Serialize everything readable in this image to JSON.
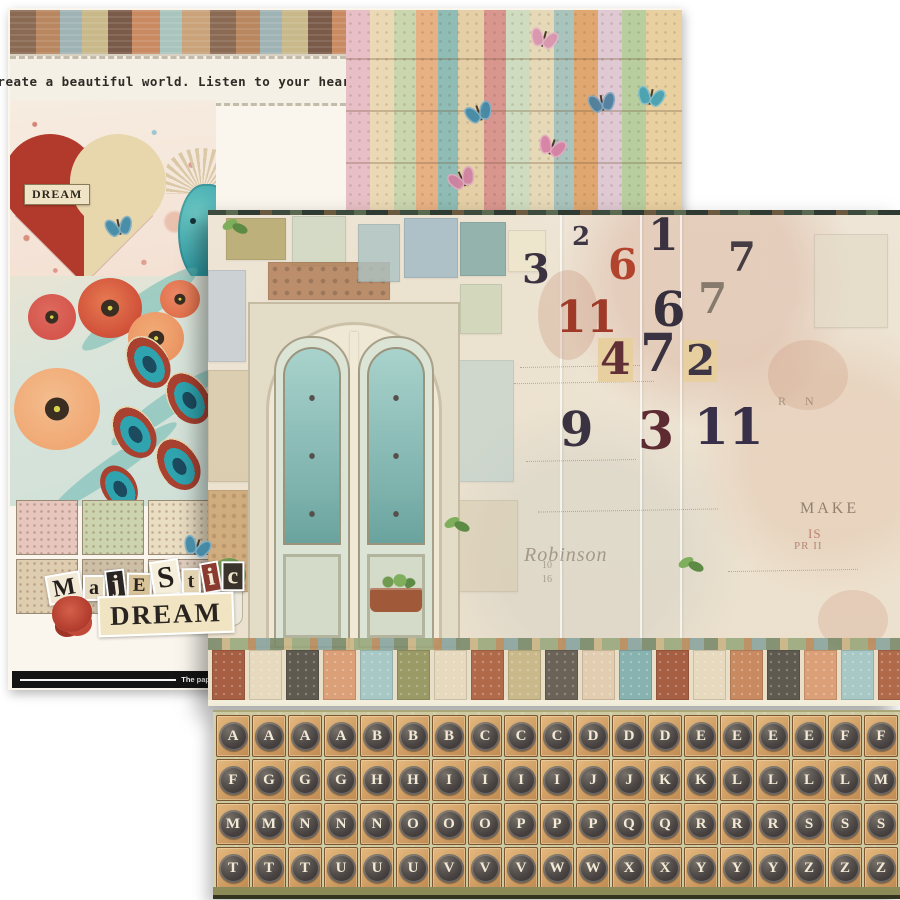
{
  "back_sheet": {
    "header_text": "Create a beautiful world.  Listen to your heart.",
    "heart_label": "DREAM",
    "title_word1": "Majestic",
    "title_word2": "DREAM",
    "footer_text": "The pap",
    "title_letters": [
      {
        "ch": "M",
        "fg": "#241f1c",
        "bg": "#f2ead6"
      },
      {
        "ch": "a",
        "fg": "#241f1c",
        "bg": "#e8dcc0"
      },
      {
        "ch": "j",
        "fg": "#f2ead6",
        "bg": "#2a2522"
      },
      {
        "ch": "E",
        "fg": "#2a2522",
        "bg": "#d9c49a"
      },
      {
        "ch": "S",
        "fg": "#241f1c",
        "bg": "#f4eeda"
      },
      {
        "ch": "t",
        "fg": "#2a2522",
        "bg": "#e2d3b2"
      },
      {
        "ch": "i",
        "fg": "#f2ead6",
        "bg": "#8a3a2e"
      },
      {
        "ch": "c",
        "fg": "#f0e6cc",
        "bg": "#3a332c"
      }
    ],
    "swatch_colors": [
      "#e6c6bd",
      "#ccd4ae",
      "#e9ddc2",
      "#dfcdb0",
      "#cdbfa6",
      "#e3d2c0"
    ],
    "patchwork": {
      "strip_colors": [
        "#e8bfc6",
        "#ead9b4",
        "#c9d6ae",
        "#e8b184",
        "#8fbcb4",
        "#e4cfa6",
        "#d9968e",
        "#cfdcc0",
        "#e6d9b8",
        "#a8c4bc",
        "#e0a870",
        "#dfc9d2",
        "#b8ce9e",
        "#e8d0a0"
      ],
      "butterfly_colors": [
        "#3e88a8",
        "#d993ae",
        "#4a7d9e",
        "#d77fa4",
        "#cf7fa0",
        "#44a0b2"
      ]
    },
    "heart_colors": {
      "left": "#b23a2c",
      "right": "#e8d6ad"
    },
    "peacock_color": "#2f9aa4",
    "poppy_colors": [
      "#cf4f38",
      "#d4554c",
      "#eb9663",
      "#f0a874",
      "#e2704a"
    ]
  },
  "front_sheet": {
    "numbers": [
      {
        "value": "2",
        "color": "#3e3644"
      },
      {
        "value": "1",
        "color": "#3a3240"
      },
      {
        "value": "3",
        "color": "#3a3240"
      },
      {
        "value": "6",
        "color": "#b2432d"
      },
      {
        "value": "7",
        "color": "#463c44"
      },
      {
        "value": "11",
        "color": "#a03a28"
      },
      {
        "value": "6",
        "color": "#362f3d"
      },
      {
        "value": "7",
        "color": "#857a6c"
      },
      {
        "value": "4",
        "color": "#613037",
        "bg": "#e7cfa0"
      },
      {
        "value": "7",
        "color": "#3a3240"
      },
      {
        "value": "2",
        "color": "#3e3644",
        "bg": "#e7cfa0"
      },
      {
        "value": "9",
        "color": "#3a3240"
      },
      {
        "value": "3",
        "color": "#5e2b33"
      },
      {
        "value": "11",
        "color": "#383048"
      }
    ],
    "script_fragments": [
      {
        "text": "MAKE",
        "color": "rgba(90,72,58,.60)"
      },
      {
        "text": "IS",
        "color": "rgba(150,62,48,.55)"
      },
      {
        "text": "PR II",
        "color": "rgba(130,55,42,.50)"
      },
      {
        "text": "Robinson",
        "color": "rgba(105,88,70,.50)",
        "italic": true
      },
      {
        "text": "R N",
        "color": "rgba(90,78,64,.45)"
      },
      {
        "text": "10",
        "color": "rgba(110,95,80,.50)"
      },
      {
        "text": "16",
        "color": "rgba(110,95,80,.50)"
      }
    ],
    "border_colors": [
      "#a65f43",
      "#e6d9bd",
      "#5f5a50",
      "#dba077",
      "#a8c8c6",
      "#9a9a66",
      "#e6d9bd",
      "#b06a4a",
      "#c9b98a",
      "#6b6358",
      "#e2cdb0",
      "#87b2b0",
      "#a65f43",
      "#e6d9bd",
      "#c98a62",
      "#5f5a50",
      "#dba077",
      "#a8c8c6",
      "#b06a4a"
    ],
    "door_colors": {
      "frame": "#efe8d4",
      "leaf": "#dce4d6",
      "glass": "#7fb3ae",
      "planter": "#a05a3a"
    }
  },
  "key_strip": {
    "background": "#cdc9a0",
    "key_tile": "#c08b52",
    "key_cap": "#474140",
    "letter_color": "#f2ead6",
    "rows": [
      [
        "A",
        "A",
        "A",
        "A",
        "B",
        "B",
        "B",
        "C",
        "C",
        "C",
        "D",
        "D",
        "D",
        "E",
        "E",
        "E",
        "E",
        "F",
        "F"
      ],
      [
        "F",
        "G",
        "G",
        "G",
        "H",
        "H",
        "I",
        "I",
        "I",
        "I",
        "J",
        "J",
        "K",
        "K",
        "L",
        "L",
        "L",
        "L",
        "M"
      ],
      [
        "M",
        "M",
        "N",
        "N",
        "N",
        "O",
        "O",
        "O",
        "P",
        "P",
        "P",
        "Q",
        "Q",
        "R",
        "R",
        "R",
        "S",
        "S",
        "S"
      ],
      [
        "T",
        "T",
        "T",
        "U",
        "U",
        "U",
        "V",
        "V",
        "V",
        "W",
        "W",
        "X",
        "X",
        "Y",
        "Y",
        "Y",
        "Z",
        "Z",
        "Z"
      ]
    ]
  }
}
